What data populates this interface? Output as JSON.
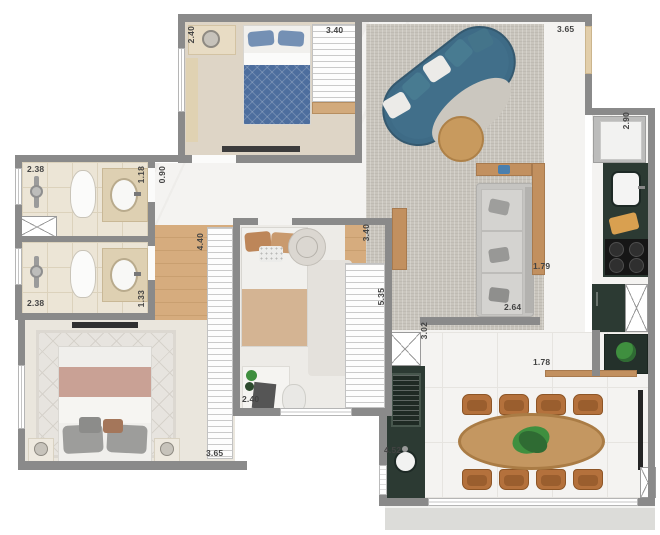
{
  "plan": {
    "kind": "apartment floor plan",
    "dimension_unit": "m"
  },
  "dimension_labels": [
    {
      "id": "bedroom1-width",
      "text": "2.40",
      "orientation": "v",
      "x": 187,
      "y": 26
    },
    {
      "id": "bedroom1-wardrobe-length",
      "text": "3.40",
      "orientation": "h",
      "x": 326,
      "y": 26
    },
    {
      "id": "living-top-width",
      "text": "3.65",
      "orientation": "h",
      "x": 557,
      "y": 25
    },
    {
      "id": "kitchen-length",
      "text": "2.90",
      "orientation": "v",
      "x": 622,
      "y": 112
    },
    {
      "id": "bath1-width",
      "text": "2.38",
      "orientation": "h",
      "x": 27,
      "y": 165
    },
    {
      "id": "bath1-depth",
      "text": "1.18",
      "orientation": "v",
      "x": 137,
      "y": 166
    },
    {
      "id": "hallway-width",
      "text": "0.90",
      "orientation": "v",
      "x": 158,
      "y": 166
    },
    {
      "id": "corridor-length",
      "text": "4.40",
      "orientation": "v",
      "x": 196,
      "y": 233
    },
    {
      "id": "bedroom2-length",
      "text": "3.40",
      "orientation": "v",
      "x": 362,
      "y": 224
    },
    {
      "id": "bath2-width",
      "text": "2.38",
      "orientation": "h",
      "x": 27,
      "y": 299
    },
    {
      "id": "bath2-depth",
      "text": "1.33",
      "orientation": "v",
      "x": 137,
      "y": 290
    },
    {
      "id": "living-length",
      "text": "5.35",
      "orientation": "v",
      "x": 377,
      "y": 288
    },
    {
      "id": "passage-width",
      "text": "1.79",
      "orientation": "h",
      "x": 533,
      "y": 262
    },
    {
      "id": "sofa-wall-length",
      "text": "2.64",
      "orientation": "h",
      "x": 504,
      "y": 303
    },
    {
      "id": "dining-depth",
      "text": "3.02",
      "orientation": "v",
      "x": 420,
      "y": 322
    },
    {
      "id": "shelf-wall-length",
      "text": "1.78",
      "orientation": "h",
      "x": 533,
      "y": 358
    },
    {
      "id": "bedroom2-width",
      "text": "2.40",
      "orientation": "h",
      "x": 242,
      "y": 395
    },
    {
      "id": "master-bedroom-width",
      "text": "3.65",
      "orientation": "h",
      "x": 206,
      "y": 449
    },
    {
      "id": "service-counter-length",
      "text": "4.52",
      "orientation": "h",
      "x": 384,
      "y": 446
    }
  ],
  "colors": {
    "wall": "#8a8a8a",
    "marble_floor": "#f4f3f1",
    "wood_floor": "#d6ac7e",
    "bath_tile": "#ece5d6",
    "living_rug": "#c9c5bd",
    "counter_dark_green": "#2c3a33",
    "sofa_blue": "#3e6b86",
    "wood_furniture": "#c2905f",
    "bed_blanket_blue": "#4d6e9e",
    "bed_blanket_rose": "#c9a195",
    "bed_blanket_tan": "#d4b493",
    "dining_chair_brown": "#b4713c",
    "dining_table_wood": "#c49761",
    "plant_green": "#3f8f3f",
    "entry_door_beige": "#e2ceaa",
    "balcony_slab": "#dcdcd9",
    "label_text": "#434343"
  },
  "furniture_icons": [
    "double-bed-blue",
    "wardrobe",
    "curved-sofa",
    "coffee-table",
    "gray-sofa",
    "sideboard",
    "fridge",
    "kitchen-sink",
    "cutting-board",
    "cooktop",
    "tall-cabinet",
    "shower",
    "toilet",
    "vanity-sink",
    "single-bed",
    "desk",
    "desk-chair",
    "pouf",
    "master-bed",
    "nightstand",
    "tv",
    "washing-machine",
    "laundry-sink",
    "dining-table",
    "dining-chair",
    "monstera-plant",
    "wall-shelf",
    "plant-cabinet"
  ]
}
